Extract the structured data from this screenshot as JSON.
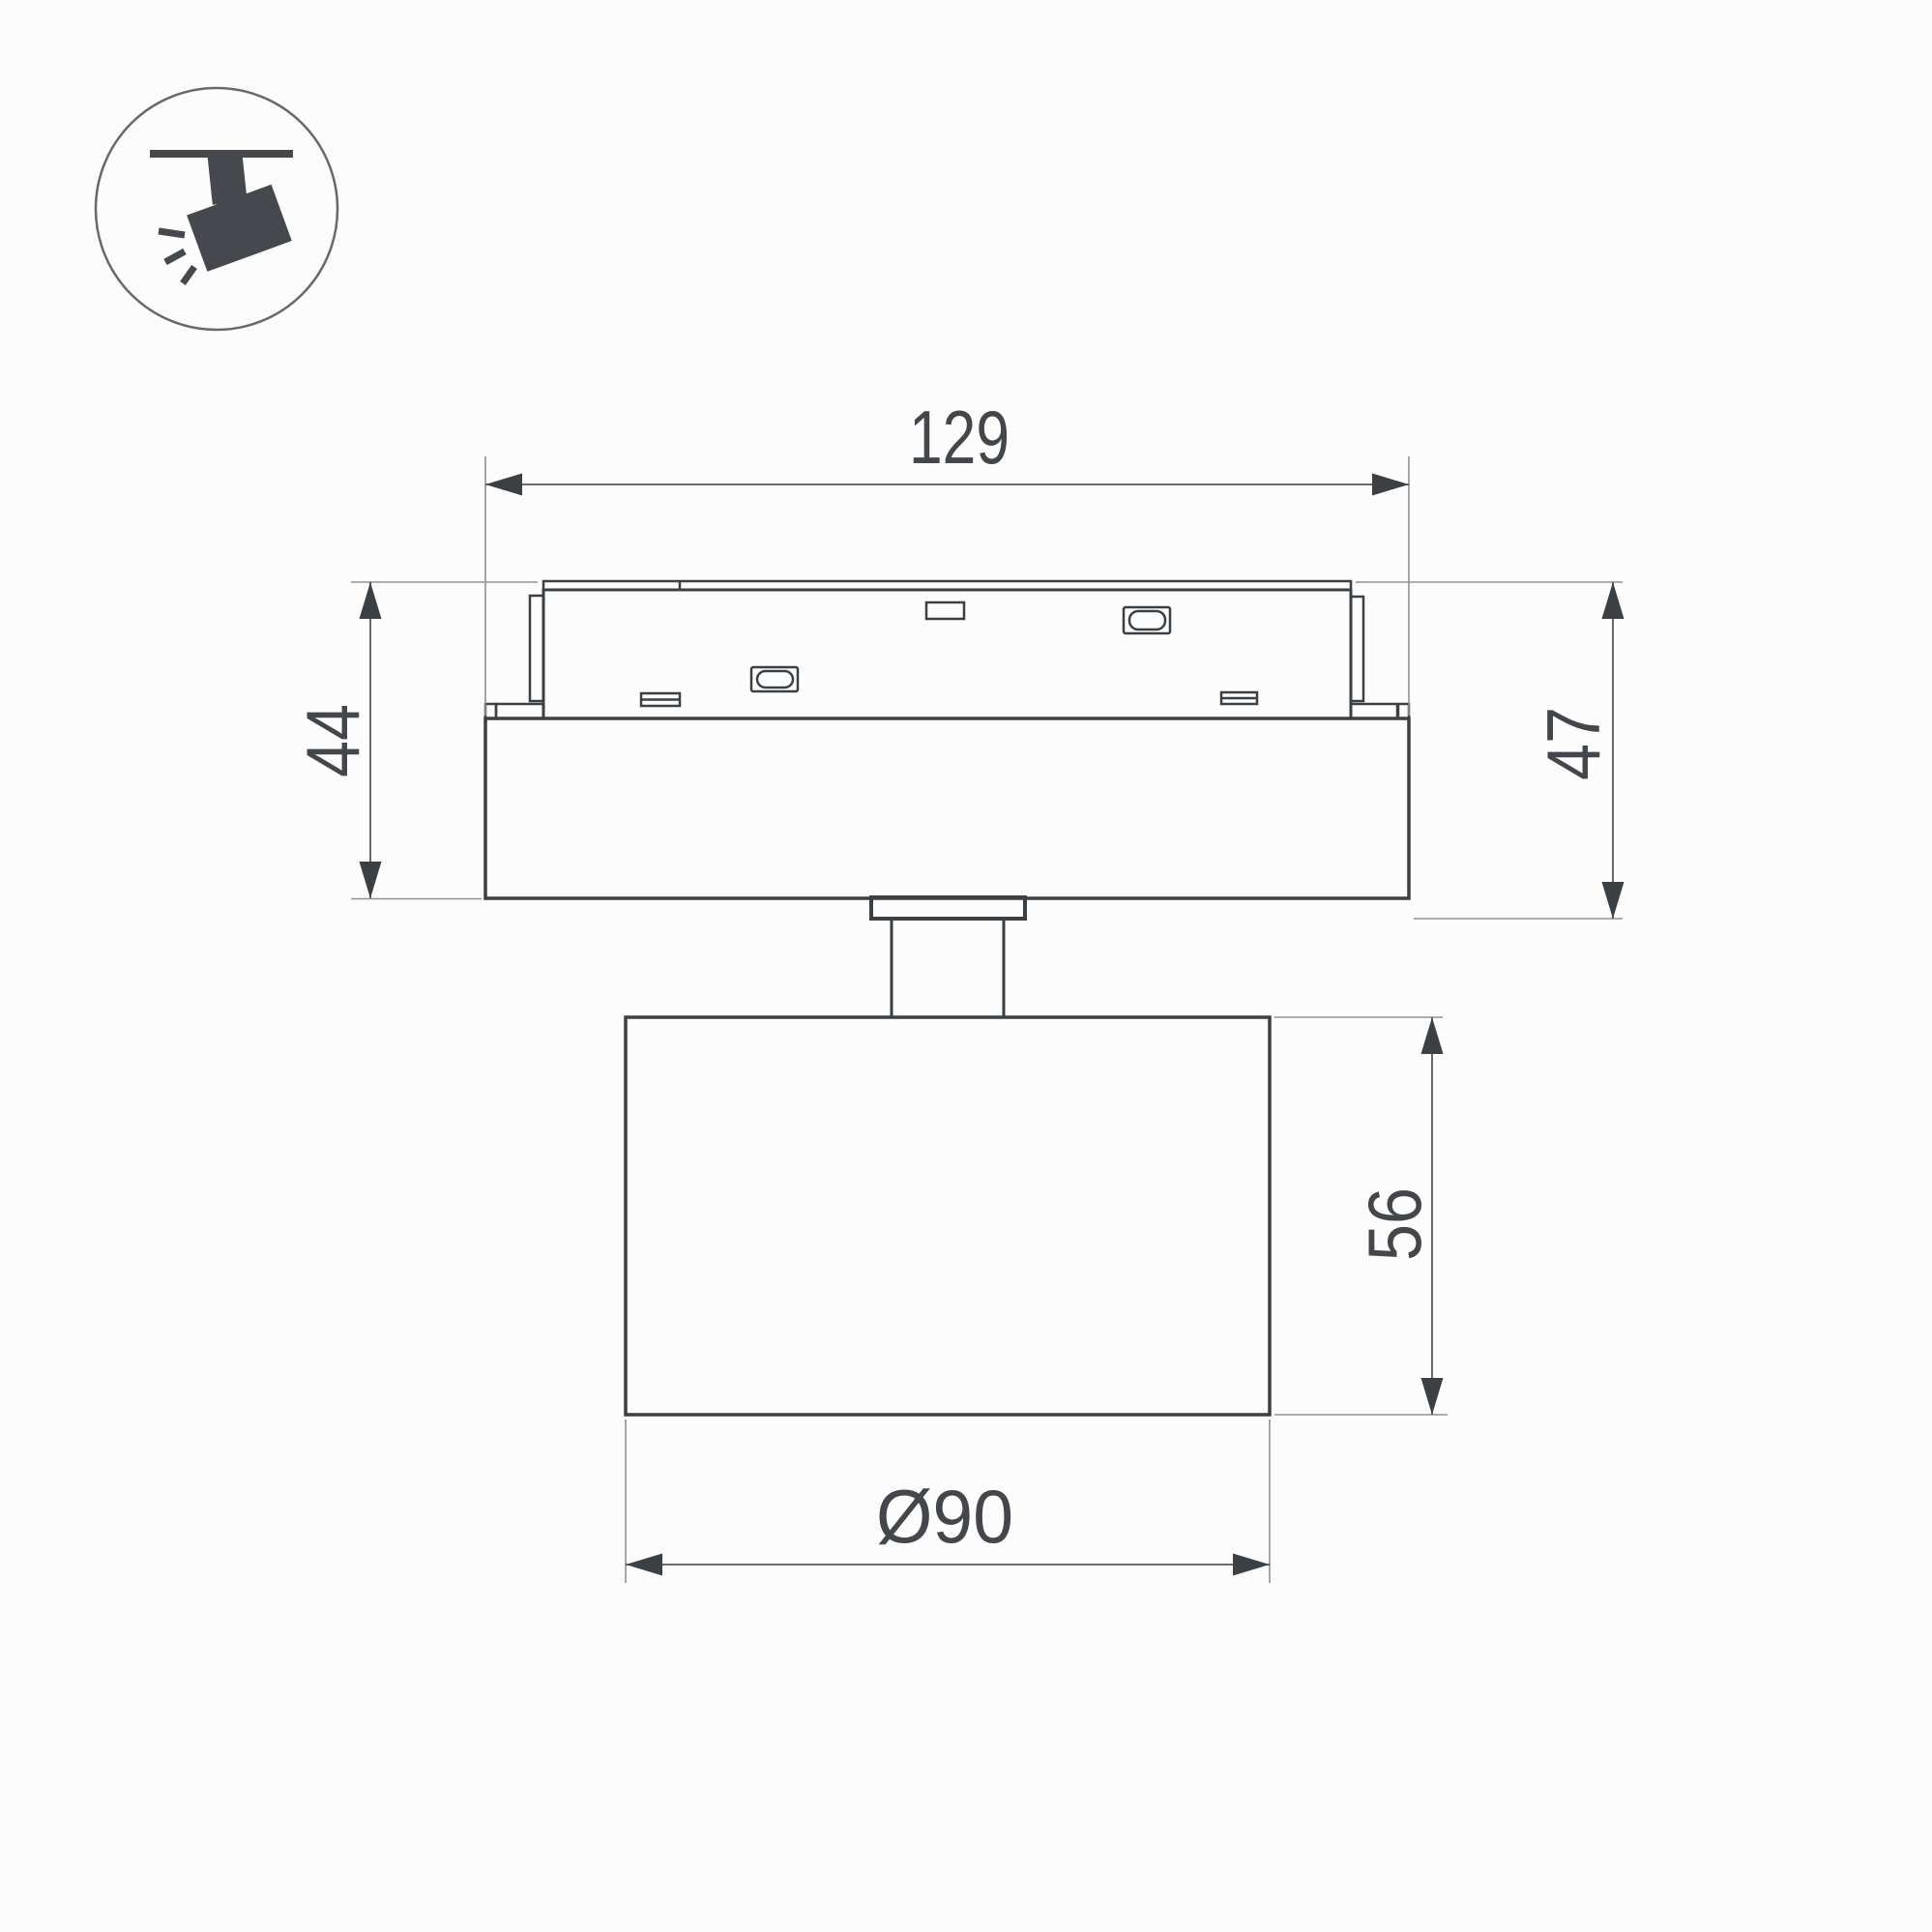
{
  "title": "Track spotlight dimensional drawing",
  "icon": {
    "name": "track-spotlight-icon",
    "description": "ceiling track with tilted spotlight and light rays"
  },
  "dimensions": {
    "adapter_length": "129",
    "adapter_height_left": "44",
    "adapter_height_right": "47",
    "head_height": "56",
    "head_diameter": "Ø90"
  },
  "colors": {
    "background": "#fcfcfc",
    "object_line": "#3b4045",
    "dimension_line": "#55585a",
    "extension_line": "#8f9193",
    "icon_fill": "#45494e",
    "icon_ring": "#66696d",
    "text": "#43474b"
  }
}
